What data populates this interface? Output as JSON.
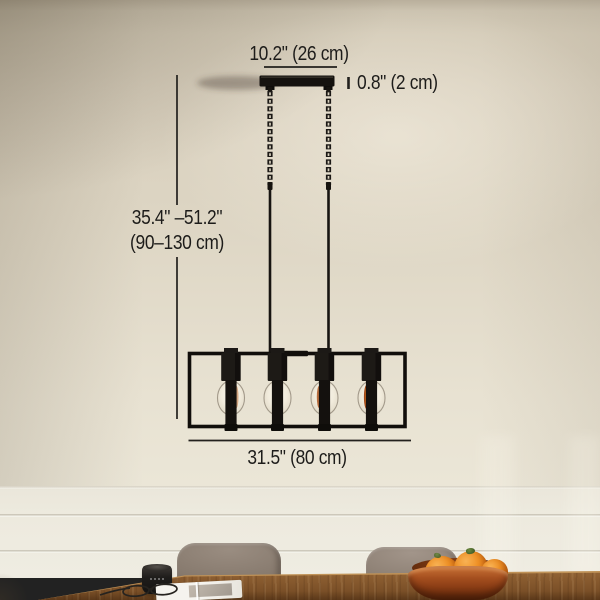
{
  "annotations": {
    "canopy_width": "10.2\" (26 cm)",
    "canopy_thickness": "0.8\" (2 cm)",
    "hanging_height_line1": "35.4\" –51.2\"",
    "hanging_height_line2": "(90–130 cm)",
    "fixture_width": "31.5\" (80 cm)"
  },
  "fixture": {
    "type": "linear open-frame chandelier, matte black, chain + rod suspension",
    "bulb_count": 4
  },
  "palette": {
    "annotation_text": "#1d1c1a",
    "fixture_black": "#15110e",
    "wall_beige": "#dcd4c2",
    "panel_white": "#ede9de",
    "table_wood": "#8a5c30",
    "chair_taupe": "#8d8176",
    "bowl_terracotta": "#9c4a1d",
    "fruit_orange": "#e8891f"
  }
}
